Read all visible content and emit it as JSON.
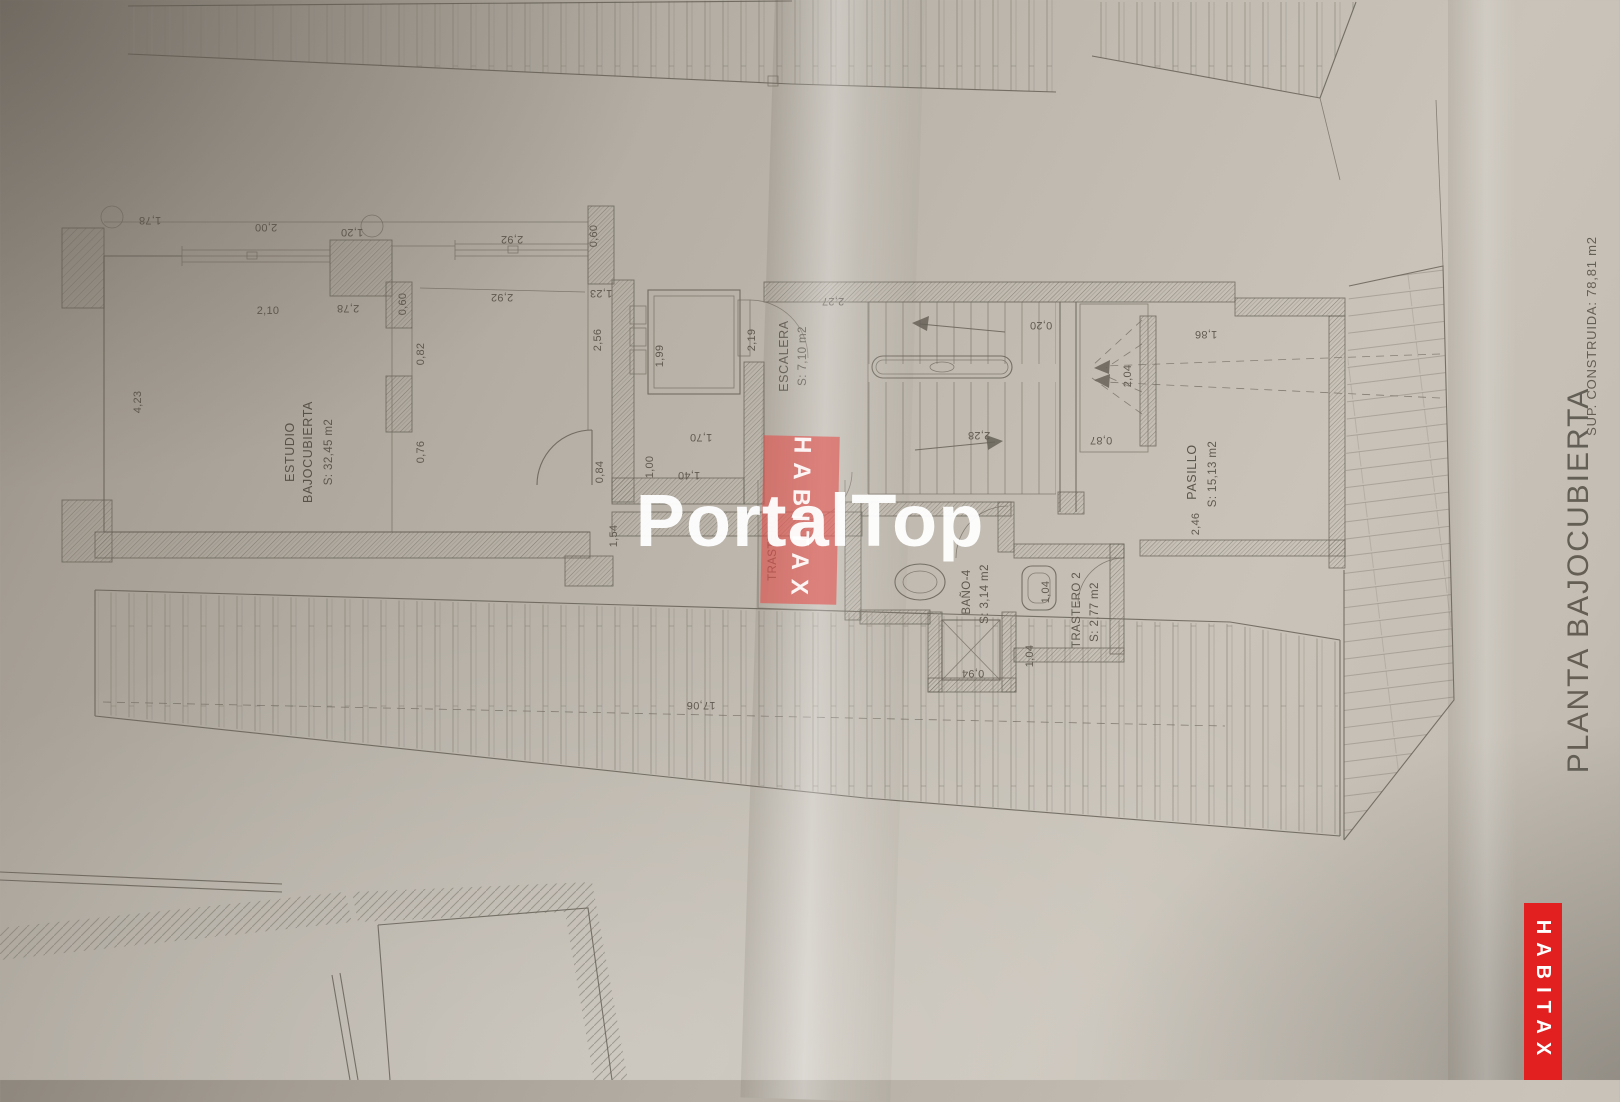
{
  "watermarks": {
    "portal_top": "PortalTop",
    "habitax": "HABITAX"
  },
  "title_block": {
    "plan_title": "PLANTA BAJOCUBIERTA",
    "built_area": "SUP. CONSTRUIDA: 78,81  m2"
  },
  "rooms": {
    "estudio": {
      "name_line1": "ESTUDIO",
      "name_line2": "BAJOCUBIERTA",
      "area": "S: 32,45 m2"
    },
    "escalera": {
      "name": "ESCALERA",
      "area": "S: 7,10 m2"
    },
    "pasillo": {
      "name": "PASILLO",
      "area": "S: 15,13 m2"
    },
    "bano": {
      "name": "BAÑO-4",
      "area": "S: 3,14 m2"
    },
    "trastero2": {
      "name": "TRASTERO 2",
      "area": "S: 2,77 m2"
    },
    "trastero1": {
      "name": "TRASTERO"
    }
  },
  "dims": [
    "1,78",
    "2,00",
    "1,20",
    "2,92",
    "0,60",
    "2,92",
    "0,60",
    "2,78",
    "2,10",
    "4,23",
    "0,82",
    "0,76",
    "1,23",
    "2,56",
    "1,99",
    "1,40",
    "2,19",
    "2,27",
    "1,70",
    "1,00",
    "0,84",
    "1,54",
    "0,20",
    "2,28",
    "2,04",
    "0,87",
    "1,86",
    "2,46",
    "1,04",
    "0,94",
    "1,04",
    "17,06"
  ]
}
